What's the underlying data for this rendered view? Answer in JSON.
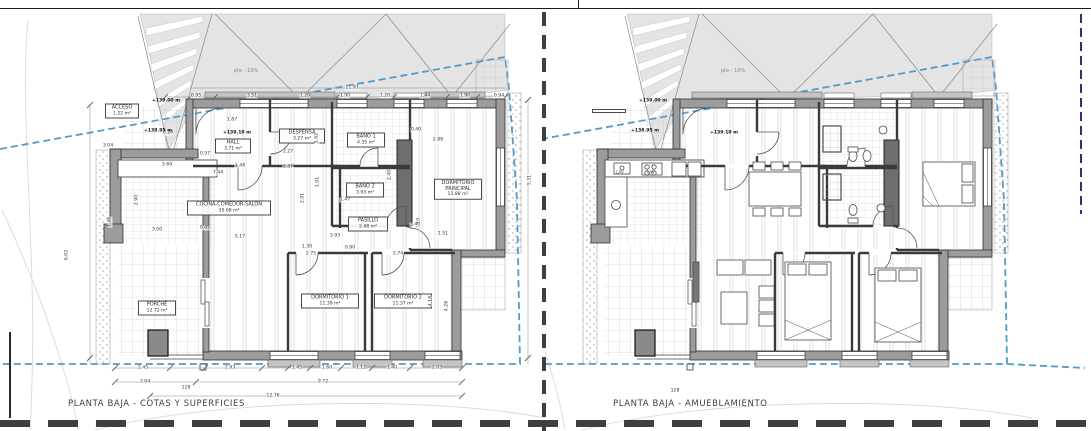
{
  "colors": {
    "boundary_blue": "#4f9bd0",
    "parcel_navy": "#2d2f86",
    "terrain_gray": "#e4e4e4",
    "wall_fill": "#9c9c9c",
    "wall_line": "#2f2f2f",
    "sheet_dash": "#3f3f3f"
  },
  "plans": [
    {
      "id": "left",
      "title": "PLANTA BAJA - COTAS Y SUPERFICIES",
      "slope_label": "pte - 10%",
      "slope_pos": {
        "x": 246,
        "y": 71
      },
      "rooms": [
        {
          "name": "ACCESO",
          "area": "1.22 m²",
          "x": 122,
          "y": 111,
          "w": 28
        },
        {
          "name": "HALL",
          "area": "3.71 m²",
          "x": 233,
          "y": 146,
          "w": 30
        },
        {
          "name": "DESPENSA",
          "area": "3.27 m²",
          "x": 302,
          "y": 136,
          "w": 40
        },
        {
          "name": "BAÑO 1",
          "area": "4.35 m²",
          "x": 366,
          "y": 140,
          "w": 32
        },
        {
          "name": "BAÑO 2",
          "area": "3.93 m²",
          "x": 365,
          "y": 190,
          "w": 32
        },
        {
          "name": "PASILLO",
          "area": "2.48 m²",
          "x": 368,
          "y": 224,
          "w": 34
        },
        {
          "name": "DORMITORIO PRINCIPAL",
          "area": "11.88 m²",
          "x": 458,
          "y": 189,
          "w": 42
        },
        {
          "name": "COCINA-COMEDOR-SALÓN",
          "area": "35.68 m²",
          "x": 229,
          "y": 208,
          "w": 78
        },
        {
          "name": "DORMITORIO 1",
          "area": "11.39 m²",
          "x": 330,
          "y": 301,
          "w": 52
        },
        {
          "name": "DORMITORIO 2",
          "area": "11.37 m²",
          "x": 403,
          "y": 301,
          "w": 52
        },
        {
          "name": "PORCHE",
          "area": "12.72 m²",
          "x": 157,
          "y": 308,
          "w": 32
        }
      ],
      "levels": [
        {
          "t": "+139.00 m",
          "x": 166,
          "y": 101
        },
        {
          "t": "+138.95 m",
          "x": 158,
          "y": 131
        },
        {
          "t": "+139.10 m",
          "x": 237,
          "y": 133
        }
      ],
      "dims": [
        {
          "t": "11.93",
          "x": 352,
          "y": 88
        },
        {
          "t": "0.95",
          "x": 196,
          "y": 96
        },
        {
          "t": "3.51",
          "x": 252,
          "y": 96
        },
        {
          "t": "1.20",
          "x": 305,
          "y": 96
        },
        {
          "t": "1.90",
          "x": 345,
          "y": 96
        },
        {
          "t": "1.20",
          "x": 385,
          "y": 96
        },
        {
          "t": "1.44",
          "x": 425,
          "y": 96
        },
        {
          "t": "1.90",
          "x": 465,
          "y": 96
        },
        {
          "t": "0.94",
          "x": 499,
          "y": 96
        },
        {
          "t": "0.20",
          "x": 168,
          "y": 133
        },
        {
          "t": "3.04",
          "x": 108,
          "y": 146
        },
        {
          "t": "1.87",
          "x": 232,
          "y": 120
        },
        {
          "t": "1.62",
          "x": 317,
          "y": 138,
          "r": 1
        },
        {
          "t": "2.27",
          "x": 288,
          "y": 152
        },
        {
          "t": "2.37",
          "x": 288,
          "y": 167
        },
        {
          "t": "1.48",
          "x": 240,
          "y": 166
        },
        {
          "t": "0.57",
          "x": 205,
          "y": 154
        },
        {
          "t": "3.60",
          "x": 167,
          "y": 165
        },
        {
          "t": "7.44",
          "x": 218,
          "y": 173
        },
        {
          "t": "2.90",
          "x": 137,
          "y": 200,
          "r": 1
        },
        {
          "t": "1.46",
          "x": 110,
          "y": 222,
          "r": 1
        },
        {
          "t": "6.02",
          "x": 67,
          "y": 255,
          "r": 1
        },
        {
          "t": "2.91",
          "x": 303,
          "y": 198,
          "r": 1
        },
        {
          "t": "1.91",
          "x": 318,
          "y": 182,
          "r": 1
        },
        {
          "t": "1.47",
          "x": 345,
          "y": 200
        },
        {
          "t": "2.40",
          "x": 390,
          "y": 175,
          "r": 1
        },
        {
          "t": "3.93",
          "x": 335,
          "y": 236
        },
        {
          "t": "5.17",
          "x": 240,
          "y": 237
        },
        {
          "t": "0.45",
          "x": 205,
          "y": 228
        },
        {
          "t": "3.00",
          "x": 157,
          "y": 230
        },
        {
          "t": "1.10",
          "x": 419,
          "y": 223,
          "r": 1
        },
        {
          "t": "3.40",
          "x": 415,
          "y": 225
        },
        {
          "t": "1.51",
          "x": 443,
          "y": 234
        },
        {
          "t": "2.88",
          "x": 438,
          "y": 140
        },
        {
          "t": "0.40",
          "x": 416,
          "y": 130
        },
        {
          "t": "5.31",
          "x": 530,
          "y": 180,
          "r": 1
        },
        {
          "t": "1.30",
          "x": 307,
          "y": 247
        },
        {
          "t": "0.90",
          "x": 350,
          "y": 248
        },
        {
          "t": "2.75",
          "x": 311,
          "y": 254
        },
        {
          "t": "2.74",
          "x": 398,
          "y": 254
        },
        {
          "t": "4.18",
          "x": 431,
          "y": 301,
          "r": 1
        },
        {
          "t": "4.28",
          "x": 447,
          "y": 306,
          "r": 1
        },
        {
          "t": "2.45",
          "x": 143,
          "y": 368
        },
        {
          "t": "2.93",
          "x": 230,
          "y": 368
        },
        {
          "t": "1.45",
          "x": 297,
          "y": 368
        },
        {
          "t": "1.60",
          "x": 327,
          "y": 368
        },
        {
          "t": "1.12",
          "x": 361,
          "y": 368
        },
        {
          "t": "1.40",
          "x": 392,
          "y": 368
        },
        {
          "t": "2.03",
          "x": 437,
          "y": 368
        },
        {
          "t": "3.04",
          "x": 145,
          "y": 382
        },
        {
          "t": "9.72",
          "x": 323,
          "y": 382
        },
        {
          "t": "12.76",
          "x": 273,
          "y": 396
        },
        {
          "t": "128",
          "x": 186,
          "y": 388
        }
      ],
      "kitchen_labels": []
    },
    {
      "id": "right",
      "title": "PLANTA BAJA - AMUEBLAMIENTO",
      "slope_label": "pte - 10%",
      "slope_pos": {
        "x": 188,
        "y": 71
      },
      "rooms": [
        {
          "name": "",
          "area": "",
          "x": 64,
          "y": 111,
          "w": 28
        }
      ],
      "levels": [
        {
          "t": "+139.00 m",
          "x": 108,
          "y": 101
        },
        {
          "t": "+138.95 m",
          "x": 100,
          "y": 131
        },
        {
          "t": "+139.10 m",
          "x": 179,
          "y": 133
        }
      ],
      "dims": [
        {
          "t": "128",
          "x": 130,
          "y": 391
        }
      ],
      "kitchen_labels": [
        {
          "t": "LAV",
          "x": 75,
          "y": 172
        },
        {
          "t": "LAV",
          "x": 106,
          "y": 172
        }
      ]
    }
  ]
}
